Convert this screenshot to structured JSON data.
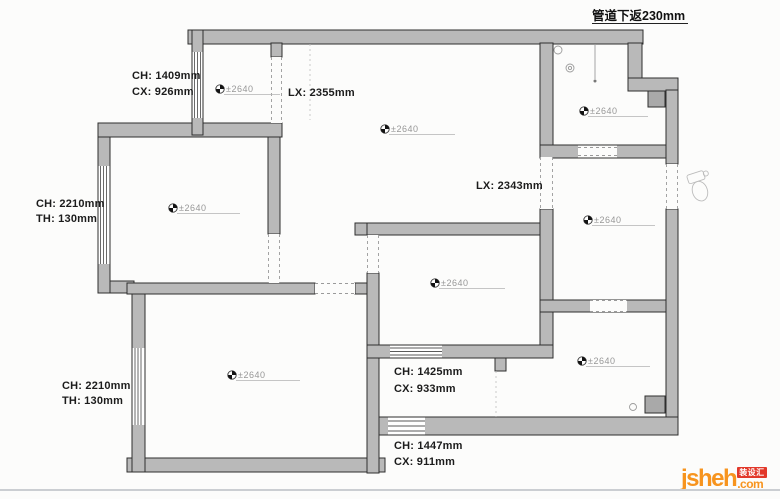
{
  "note_top": "管道下返230mm",
  "levels": [
    "±2640",
    "±2640",
    "±2640",
    "±2640",
    "±2640",
    "±2640",
    "±2640",
    "±2640"
  ],
  "dims": {
    "entry": {
      "l1": "CH: 1409mm",
      "l2": "CX: 926mm"
    },
    "hall_lx": "LX: 2355mm",
    "left_upper": {
      "l1": "CH: 2210mm",
      "l2": "TH: 130mm"
    },
    "corridor_lx": "LX: 2343mm",
    "left_lower": {
      "l1": "CH: 2210mm",
      "l2": "TH: 130mm"
    },
    "bath_upper": {
      "l1": "CH: 1425mm",
      "l2": "CX: 933mm"
    },
    "bath_lower": {
      "l1": "CH: 1447mm",
      "l2": "CX: 911mm"
    }
  },
  "logo": {
    "name": "jsheh",
    "tld": ".com",
    "badge": "装设汇"
  },
  "colors": {
    "wall": "#b9b9b9",
    "wall_edge": "#2e2e2e",
    "level_text": "#979797",
    "dim_text": "#1c1c1c",
    "logo_orange": "#f7941e",
    "badge_red": "#e2382a",
    "divider": "#cbced2"
  }
}
